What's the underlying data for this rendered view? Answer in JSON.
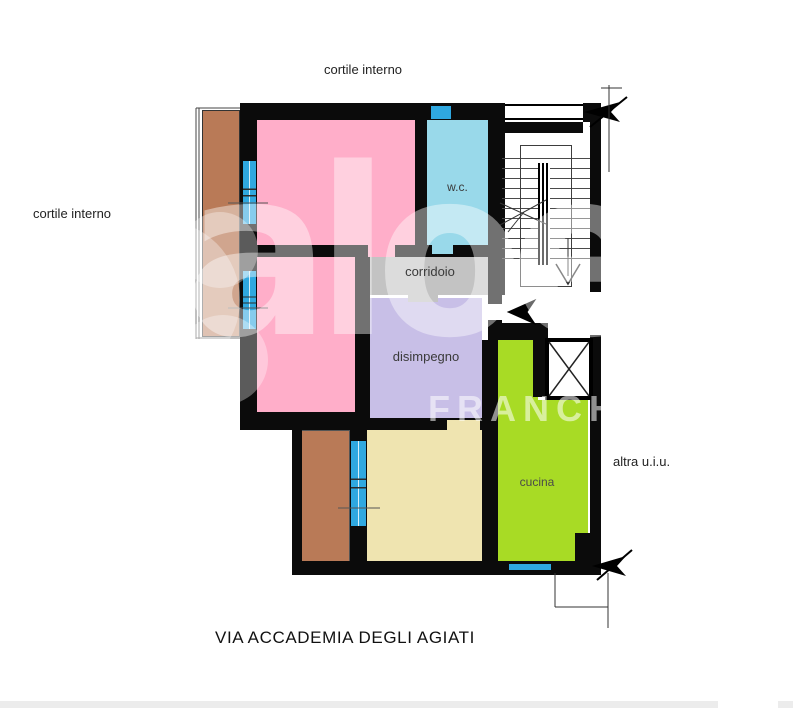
{
  "labels": {
    "cortile_top": "cortile interno",
    "cortile_left": "cortile interno",
    "altra_uiu": "altra u.i.u.",
    "street": "VIA ACCADEMIA DEGLI AGIATI"
  },
  "rooms": {
    "wc": "w.c.",
    "corridoio": "corridoio",
    "disimpegno": "disimpegno",
    "cucina": "cucina"
  },
  "watermark": {
    "brand": "aloe",
    "sub": "FRANCH"
  },
  "colors": {
    "wall": "#0b0b0b",
    "bedroom_pink": "#FFAEC9",
    "wc_blue": "#99D9EA",
    "corridoio_gray": "#C3C3C3",
    "disimpegno_lavender": "#C8BFE7",
    "cucina_green": "#A8DB25",
    "room_beige": "#EFE4B0",
    "balcony_brown": "#B97A57",
    "window_blue": "#2FA8E0"
  }
}
